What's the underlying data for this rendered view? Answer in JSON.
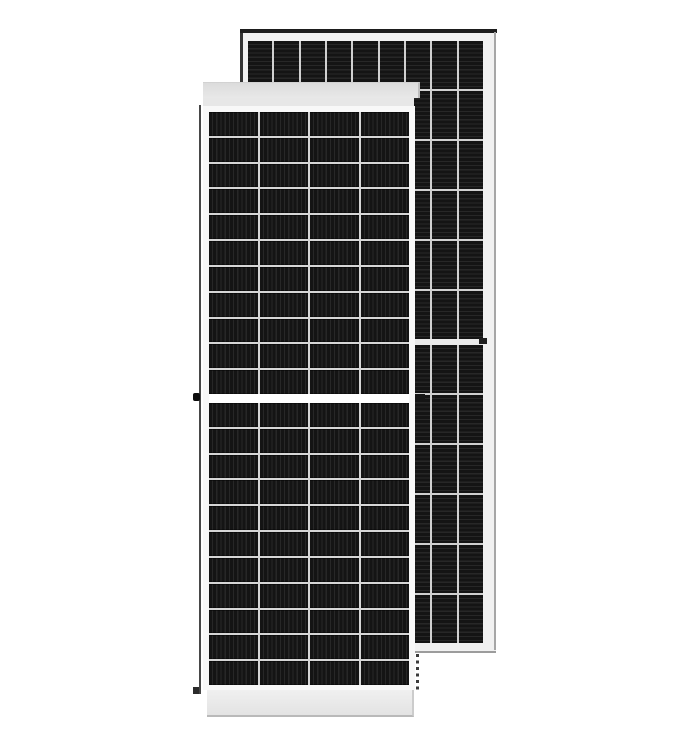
{
  "scene": {
    "subject": "two framed solar panel modules on a white background",
    "front_panel_label": "front solar panel module",
    "back_panel_label": "rear solar panel module"
  },
  "colors": {
    "background": "#ffffff",
    "cell_dark": "#141414",
    "cell_stripe": "#272727",
    "grid_gap_front": "#d6d6d6",
    "grid_gap_back": "#d0d0d0",
    "frame_front": "#f8f8f8",
    "frame_back": "#f1f1f1",
    "edge_dark": "#1d1d1d",
    "edge_gray": "#a6a6a6"
  },
  "front_panel": {
    "columns": 4,
    "rows_per_half": 11,
    "halves": 2,
    "stripe_direction": "vertical"
  },
  "back_panel": {
    "columns": 9,
    "rows_per_half": 6,
    "halves": 2,
    "stripe_direction": "horizontal"
  }
}
